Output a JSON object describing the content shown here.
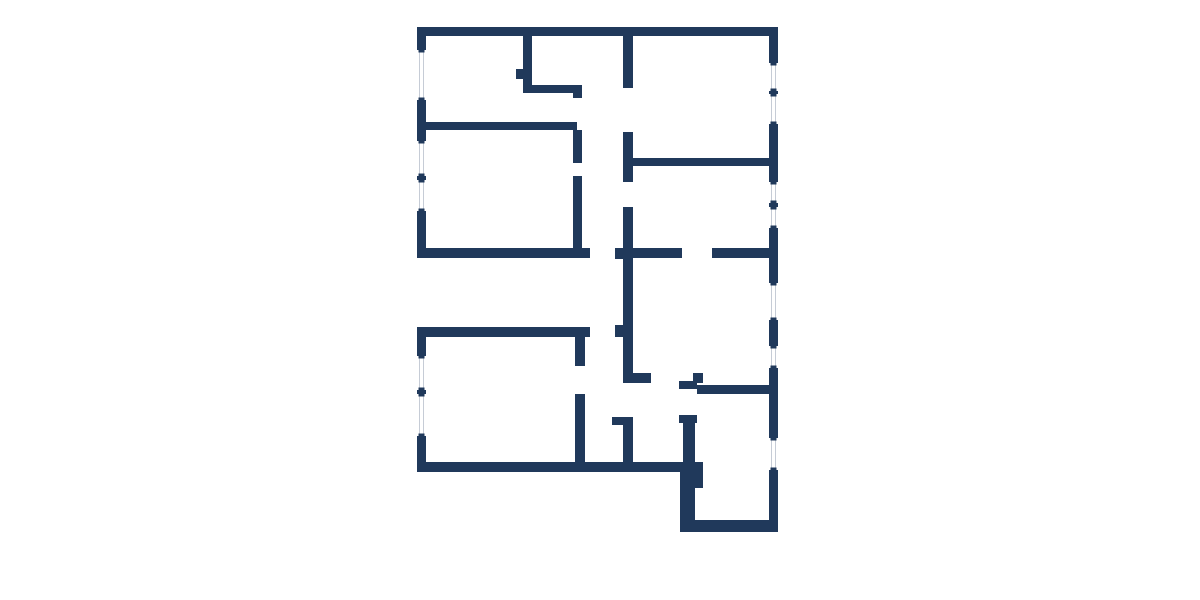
{
  "floorplan": {
    "labels": {
      "kueche": "Küche",
      "badezimmer2": "Badezimmer 2",
      "kinderzimmer2": "Kinderzimmer 2",
      "wohnzimmer": "Wohnzimmer",
      "flur_oben": "Flur",
      "esszimmer": "Esszimmer",
      "kinderzimmer1": "Kinderzimmer 1",
      "schlafzimmer": "Schlafzimmer",
      "flur_unten": "Flur",
      "abstellraum": "Abstellraum",
      "badezimmer1": "Badezimmer 1"
    },
    "watermark": "D",
    "compass": {
      "north": "N",
      "east": "O",
      "south": "S",
      "west": "W"
    },
    "colors": {
      "wall": "#20395b",
      "label_text": "#2a4566",
      "door_line": "#b9c0c9",
      "window_line": "#c6ccd6",
      "watermark": "#c9cfe0"
    }
  }
}
